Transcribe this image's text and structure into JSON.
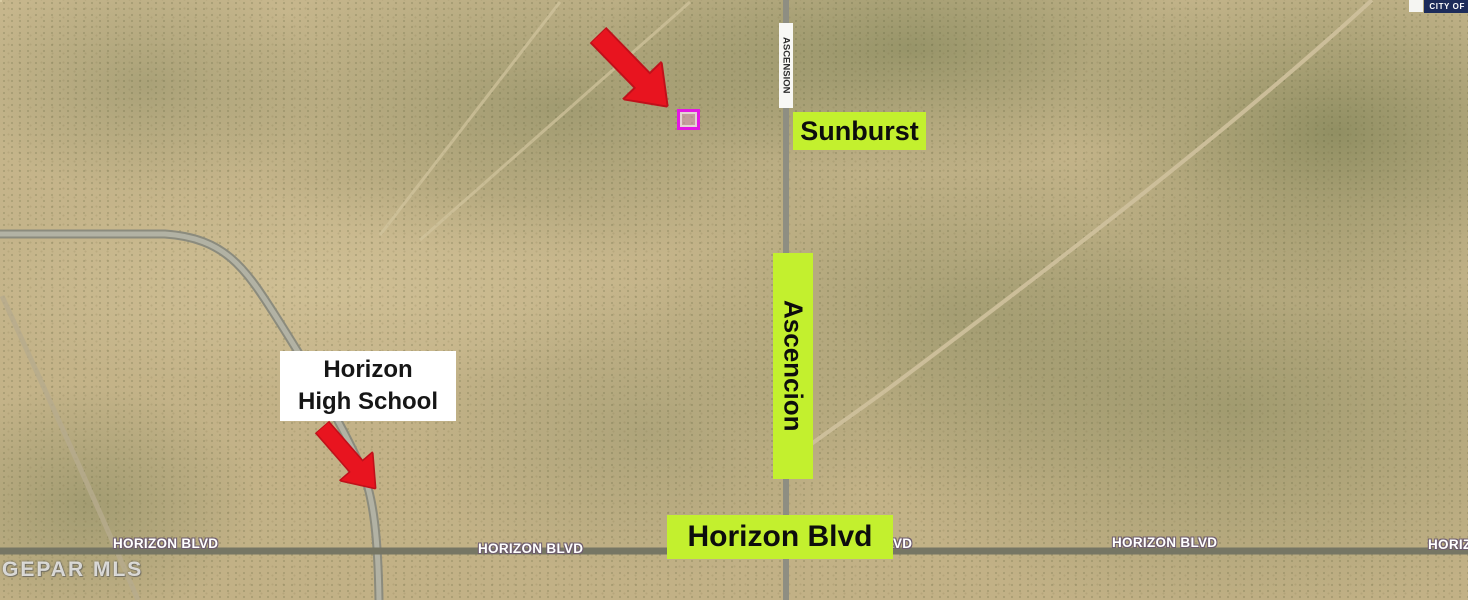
{
  "map_labels": {
    "sunburst": "Sunburst",
    "ascencion_road_band": "Ascencion",
    "horizon_blvd_band": "Horizon Blvd",
    "school_name_line1": "Horizon",
    "school_name_line2": "High School"
  },
  "street_names": {
    "ascension_vertical": "ASCENSION",
    "horizon_blvd_labels": [
      "HORIZON BLVD",
      "HORIZON BLVD",
      "HORIZON BLVD",
      "HORIZON BLVD",
      "HORIZON BLVD"
    ]
  },
  "overlays": {
    "city_banner_text": "CITY OF",
    "watermark_text": "GEPAR MLS"
  },
  "colors": {
    "highlight_green": "#c3f02e",
    "annotation_text_black": "#0d0d0d",
    "arrow_red": "#e8141f",
    "parcel_marker_magenta": "#e318e3",
    "city_banner_navy": "#1d2c5a",
    "street_label_white": "#ffffff"
  }
}
